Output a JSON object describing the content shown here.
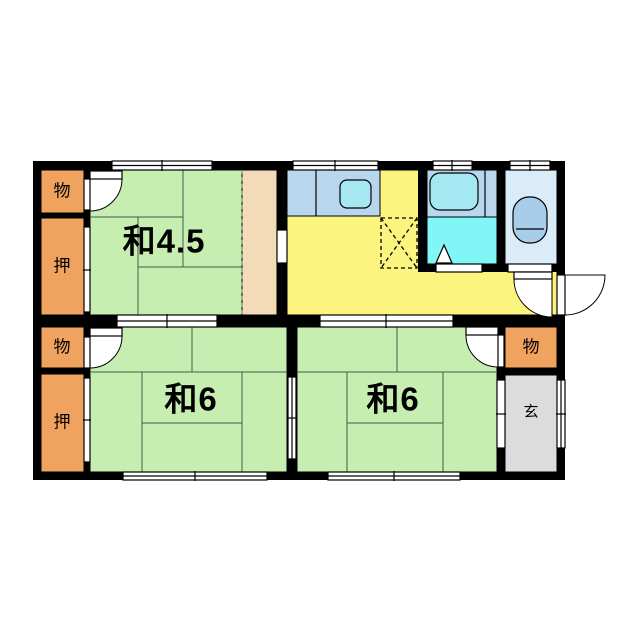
{
  "floorplan": {
    "rooms": {
      "storage_top_left": {
        "label": "物"
      },
      "closet_top_left": {
        "label": "押"
      },
      "washitsu_45": {
        "label": "和4.5"
      },
      "washitsu_6_left": {
        "label": "和6"
      },
      "washitsu_6_right": {
        "label": "和6"
      },
      "storage_bottom_left": {
        "label": "物"
      },
      "closet_bottom_left": {
        "label": "押"
      },
      "storage_right": {
        "label": "物"
      },
      "genkan": {
        "label": "玄"
      }
    },
    "colors": {
      "wall": "#000000",
      "tatami": "#c6eeb1",
      "engawa": "#f3dbb7",
      "closet": "#f0a25f",
      "kitchen": "#fbf47e",
      "bath": "#80f6f6",
      "counter": "#b9d6ef",
      "fixture": "#a5e8f2",
      "toilet_room": "#daecf8",
      "toilet_fixture": "#a8cde8",
      "genkan_floor": "#dcdcdc",
      "mat_line": "#4a5a4a",
      "dashed": "#6f9f6f"
    }
  }
}
